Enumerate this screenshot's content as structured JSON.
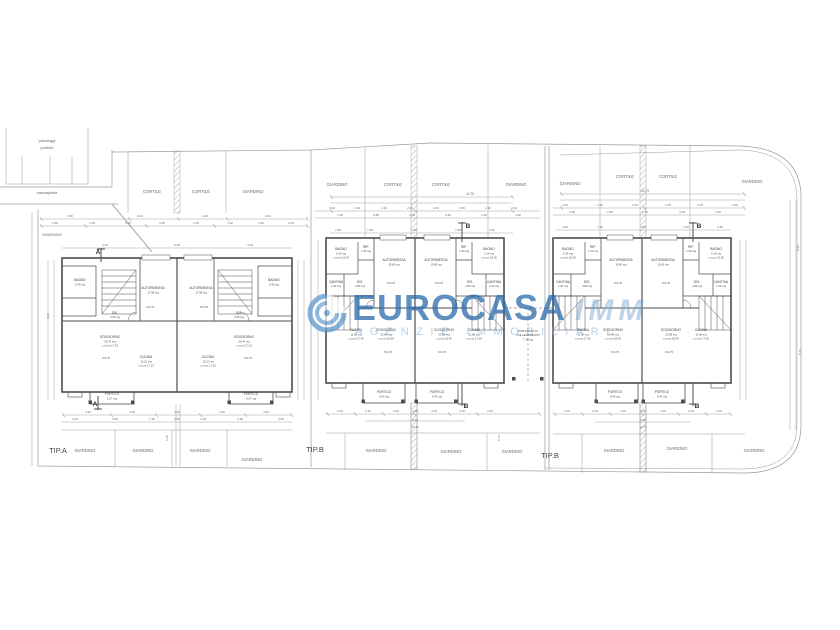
{
  "watermark": {
    "brand": "EUROCASA",
    "brand_suffix": "IMM",
    "tagline": "AGENZIE IMMOBILIARI",
    "accent": "#2e7cbe",
    "accent_light": "#9cc4e4"
  },
  "plan": {
    "line_color": "#9a9a9a",
    "wall_color": "#4d4d4d",
    "texts": {
      "site": [
        [
          "parcheggi",
          47,
          142,
          3.8
        ],
        [
          "pubblici",
          47,
          149,
          3.8
        ],
        [
          "marciapiede",
          47,
          194,
          3.8
        ],
        [
          "GIARDINO",
          52,
          236,
          4
        ],
        [
          "CORTILE",
          152,
          193
        ],
        [
          "CORTILE",
          201,
          193
        ],
        [
          "GIARDINO",
          253,
          193
        ],
        [
          "GIARDINO",
          337,
          186
        ],
        [
          "CORTILE",
          393,
          186
        ],
        [
          "CORTILE",
          441,
          186
        ],
        [
          "GIARDINO",
          516,
          186
        ],
        [
          "GIARDINO",
          570,
          185
        ],
        [
          "CORTILE",
          625,
          178
        ],
        [
          "CORTILE",
          668,
          178
        ],
        [
          "GIARDINO",
          752,
          183
        ],
        [
          "GIARDINO",
          85,
          452
        ],
        [
          "GIARDINO",
          143,
          452
        ],
        [
          "GIARDINO",
          200,
          452
        ],
        [
          "GIARDINO",
          252,
          461
        ],
        [
          "GIARDINO",
          376,
          452
        ],
        [
          "GIARDINO",
          451,
          453
        ],
        [
          "GIARDINO",
          512,
          453
        ],
        [
          "GIARDINO",
          614,
          452
        ],
        [
          "GIARDINO",
          677,
          450
        ],
        [
          "GIARDINO",
          754,
          452
        ]
      ],
      "tip": [
        [
          "TIP.A",
          58,
          453
        ],
        [
          "TIP.B",
          315,
          452
        ],
        [
          "TIP.B",
          550,
          458
        ]
      ],
      "rooms": [
        [
          "BAGNO",
          80,
          281
        ],
        [
          "DIS.",
          115,
          314
        ],
        [
          "AUTORIMESSA",
          153,
          289
        ],
        [
          "SOGGIORNO",
          110,
          338
        ],
        [
          "CUCINA",
          146,
          358
        ],
        [
          "PORTICO",
          112,
          395
        ],
        [
          "AUTORIMESSA",
          201,
          289
        ],
        [
          "BAGNO",
          274,
          281
        ],
        [
          "DIS.",
          239,
          314
        ],
        [
          "SOGGIORNO",
          244,
          338
        ],
        [
          "CUCINA",
          208,
          358
        ],
        [
          "PORTICO",
          251,
          395
        ],
        [
          "BAGNO",
          341,
          250
        ],
        [
          "RIP.",
          366,
          248
        ],
        [
          "AUTORIMESSA",
          394,
          261
        ],
        [
          "CANTINA",
          336,
          283
        ],
        [
          "DIS.",
          360,
          283
        ],
        [
          "CUCINA",
          356,
          331
        ],
        [
          "SOGGIORNO",
          386,
          331
        ],
        [
          "PORTICO",
          384,
          393
        ],
        [
          "AUTORIMESSA",
          436,
          261
        ],
        [
          "RIP.",
          464,
          248
        ],
        [
          "BAGNO",
          489,
          250
        ],
        [
          "DIS.",
          470,
          283
        ],
        [
          "CANTINA",
          494,
          283
        ],
        [
          "SOGGIORNO",
          444,
          331
        ],
        [
          "CUCINA",
          474,
          331
        ],
        [
          "PORTICO",
          437,
          393
        ],
        [
          "PORTICATO DI",
          528,
          332,
          2.8
        ],
        [
          "COLLEGAMENTO",
          528,
          336.2,
          2.8
        ],
        [
          "BAGNO",
          568,
          250
        ],
        [
          "RIP.",
          593,
          248
        ],
        [
          "AUTORIMESSA",
          621,
          261
        ],
        [
          "CANTINA",
          563,
          283
        ],
        [
          "DIS.",
          587,
          283
        ],
        [
          "CUCINA",
          583,
          331
        ],
        [
          "SOGGIORNO",
          613,
          331
        ],
        [
          "PORTICO",
          615,
          393
        ],
        [
          "AUTORIMESSA",
          663,
          261
        ],
        [
          "RIP.",
          691,
          248
        ],
        [
          "BAGNO",
          716,
          250
        ],
        [
          "DIS.",
          697,
          283
        ],
        [
          "CANTINA",
          721,
          283
        ],
        [
          "SOGGIORNO",
          671,
          331
        ],
        [
          "CUCINA",
          701,
          331
        ],
        [
          "PORTICO",
          662,
          393
        ]
      ],
      "areas": [
        [
          "5.40 mq",
          80,
          285.5
        ],
        [
          "3.96 mq",
          115,
          318
        ],
        [
          "17.98 mq",
          153,
          293.5
        ],
        [
          "h=2.70",
          150,
          308
        ],
        [
          "20.47 mq",
          110,
          342.5
        ],
        [
          "c.m.un 17.23",
          110,
          346.7
        ],
        [
          "h=2.70",
          106,
          359
        ],
        [
          "12.10 mq",
          146,
          362.5
        ],
        [
          "c.m.un 17.23",
          146,
          366.7
        ],
        [
          "5.27 mq",
          112,
          399.5
        ],
        [
          "17.98 mq",
          201,
          293.5
        ],
        [
          "h=2.70",
          204,
          308
        ],
        [
          "5.40 mq",
          274,
          285.5
        ],
        [
          "3.96 mq",
          239,
          318
        ],
        [
          "20.47 mq",
          244,
          342.5
        ],
        [
          "c.m.un 17.23",
          244,
          346.7
        ],
        [
          "h=2.70",
          248,
          359
        ],
        [
          "12.10 mq",
          208,
          362.5
        ],
        [
          "c.m.un 17.23",
          208,
          366.7
        ],
        [
          "5.27 mq",
          251,
          399.5
        ],
        [
          "5.14 mq",
          341,
          254.5
        ],
        [
          "c.m.un 15.05",
          341,
          258.7
        ],
        [
          "1.30 mq",
          366,
          252.2
        ],
        [
          "15.60 mq",
          394,
          265.5
        ],
        [
          "h=2.70",
          391,
          284
        ],
        [
          "1.62 mq",
          336,
          287.2
        ],
        [
          "4.80 mq",
          360,
          287.2
        ],
        [
          "11.80 mq",
          356,
          335.5
        ],
        [
          "c.m.un 17.00",
          356,
          339.7
        ],
        [
          "23.88 mq",
          386,
          335.5
        ],
        [
          "c.m.un 18.00",
          386,
          339.7
        ],
        [
          "h=2.70",
          388,
          353
        ],
        [
          "8.43 mq",
          384,
          397.5
        ],
        [
          "15.60 mq",
          436,
          265.5
        ],
        [
          "h=2.70",
          439,
          284
        ],
        [
          "1.30 mq",
          464,
          252.2
        ],
        [
          "5.14 mq",
          489,
          254.5
        ],
        [
          "c.m.un 15.05",
          489,
          258.7
        ],
        [
          "4.80 mq",
          470,
          287.2
        ],
        [
          "1.62 mq",
          494,
          287.2
        ],
        [
          "23.88 mq",
          444,
          335.5
        ],
        [
          "c.m.un 18.00",
          444,
          339.7
        ],
        [
          "h=2.70",
          442,
          353
        ],
        [
          "11.80 mq",
          474,
          335.5
        ],
        [
          "c.m.un 17.00",
          474,
          339.7
        ],
        [
          "8.43 mq",
          437,
          397.5
        ],
        [
          "7.18 mq",
          528,
          340.4
        ],
        [
          "5.14 mq",
          568,
          254.5
        ],
        [
          "c.m.un 15.05",
          568,
          258.7
        ],
        [
          "1.30 mq",
          593,
          252.2
        ],
        [
          "15.60 mq",
          621,
          265.5
        ],
        [
          "h=2.70",
          618,
          284
        ],
        [
          "1.62 mq",
          563,
          287.2
        ],
        [
          "4.80 mq",
          587,
          287.2
        ],
        [
          "11.80 mq",
          583,
          335.5
        ],
        [
          "c.m.un 17.00",
          583,
          339.7
        ],
        [
          "23.88 mq",
          613,
          335.5
        ],
        [
          "c.m.un 18.00",
          613,
          339.7
        ],
        [
          "h=2.70",
          615,
          353
        ],
        [
          "8.43 mq",
          615,
          397.5
        ],
        [
          "15.60 mq",
          663,
          265.5
        ],
        [
          "h=2.70",
          666,
          284
        ],
        [
          "1.30 mq",
          691,
          252.2
        ],
        [
          "5.14 mq",
          716,
          254.5
        ],
        [
          "c.m.un 15.05",
          716,
          258.7
        ],
        [
          "4.80 mq",
          697,
          287.2
        ],
        [
          "1.62 mq",
          721,
          287.2
        ],
        [
          "23.88 mq",
          671,
          335.5
        ],
        [
          "c.m.un 18.00",
          671,
          339.7
        ],
        [
          "h=2.70",
          669,
          353
        ],
        [
          "11.80 mq",
          701,
          335.5
        ],
        [
          "c.m.un 17.00",
          701,
          339.7
        ],
        [
          "8.43 mq",
          662,
          397.5
        ]
      ],
      "dims": [
        [
          "4.80",
          70,
          217
        ],
        [
          "4.19",
          140,
          217
        ],
        [
          "4.40",
          205,
          217
        ],
        [
          "4.60",
          268,
          217
        ],
        [
          "2.56",
          55,
          224
        ],
        [
          "1.50",
          92,
          224
        ],
        [
          "3.15",
          128,
          224
        ],
        [
          "0.45",
          162,
          224
        ],
        [
          "2.40",
          196,
          224
        ],
        [
          "1.90",
          230,
          224
        ],
        [
          "1.40",
          261,
          224
        ],
        [
          "2.55",
          291,
          224
        ],
        [
          "4.19",
          105,
          246
        ],
        [
          "6.18",
          177,
          246
        ],
        [
          "4.19",
          250,
          246
        ],
        [
          "14.75",
          470,
          195,
          3.2
        ],
        [
          "3.30",
          332,
          209
        ],
        [
          "1.30",
          357,
          209
        ],
        [
          "4.10",
          384,
          209
        ],
        [
          "2.30",
          410,
          209
        ],
        [
          "1.60",
          436,
          209
        ],
        [
          "3.45",
          462,
          209
        ],
        [
          "1.90",
          488,
          209
        ],
        [
          "3.30",
          514,
          209
        ],
        [
          "1.90",
          340,
          216
        ],
        [
          "2.85",
          376,
          216
        ],
        [
          "1.30",
          412,
          216
        ],
        [
          "3.20",
          448,
          216
        ],
        [
          "1.40",
          484,
          216
        ],
        [
          "1.90",
          518,
          216
        ],
        [
          "2.56",
          338,
          231
        ],
        [
          "1.50",
          370,
          231
        ],
        [
          "4.50",
          414,
          231
        ],
        [
          "1.50",
          458,
          231
        ],
        [
          "2.56",
          492,
          231
        ],
        [
          "14.75",
          645,
          192,
          3.2
        ],
        [
          "3.30",
          565,
          206
        ],
        [
          "4.10",
          600,
          206
        ],
        [
          "2.30",
          635,
          206
        ],
        [
          "1.60",
          668,
          206
        ],
        [
          "3.45",
          700,
          206
        ],
        [
          "3.30",
          735,
          206
        ],
        [
          "1.90",
          572,
          213
        ],
        [
          "2.85",
          610,
          213
        ],
        [
          "1.30",
          645,
          213
        ],
        [
          "3.20",
          682,
          213
        ],
        [
          "1.90",
          718,
          213
        ],
        [
          "2.56",
          565,
          228
        ],
        [
          "1.50",
          600,
          228
        ],
        [
          "4.50",
          643,
          228
        ],
        [
          "1.50",
          686,
          228
        ],
        [
          "2.56",
          720,
          228
        ],
        [
          "4.50",
          88,
          413
        ],
        [
          "4.20",
          132,
          413
        ],
        [
          "3.90",
          177,
          413
        ],
        [
          "4.20",
          222,
          413
        ],
        [
          "4.50",
          266,
          413
        ],
        [
          "3.30",
          75,
          420
        ],
        [
          "4.50",
          115,
          420
        ],
        [
          "1.35",
          152,
          420
        ],
        [
          "3.90",
          177,
          420
        ],
        [
          "1.35",
          203,
          420
        ],
        [
          "4.35",
          240,
          420
        ],
        [
          "3.50",
          281,
          420
        ],
        [
          "5.18",
          168,
          438,
          3,
          -90
        ],
        [
          "2.40",
          340,
          412
        ],
        [
          "3.10",
          368,
          412
        ],
        [
          "4.20",
          396,
          412
        ],
        [
          "1.35",
          415,
          412
        ],
        [
          "4.20",
          434,
          412
        ],
        [
          "3.10",
          462,
          412
        ],
        [
          "2.40",
          490,
          412
        ],
        [
          "9.35",
          415,
          421
        ],
        [
          "14.75",
          415,
          428
        ],
        [
          "5.73",
          500,
          438,
          3,
          -90
        ],
        [
          "2.40",
          567,
          412
        ],
        [
          "3.10",
          595,
          412
        ],
        [
          "4.20",
          623,
          412
        ],
        [
          "1.35",
          643,
          412
        ],
        [
          "4.20",
          663,
          412
        ],
        [
          "3.10",
          691,
          412
        ],
        [
          "2.40",
          719,
          412
        ],
        [
          "9.35",
          643,
          421
        ],
        [
          "14.75",
          643,
          428
        ],
        [
          "5.90",
          799,
          248,
          3,
          -90
        ],
        [
          "5.74",
          801,
          352,
          3,
          -90
        ],
        [
          "9.30",
          49,
          316,
          3,
          -90
        ],
        [
          "5.45",
          319,
          312,
          3,
          -90
        ]
      ],
      "markers": [
        [
          "A",
          98,
          254
        ],
        [
          "A",
          95,
          406
        ],
        [
          "B",
          468,
          228
        ],
        [
          "B",
          466,
          408
        ],
        [
          "B",
          699,
          228
        ],
        [
          "B",
          697,
          408
        ]
      ]
    }
  }
}
